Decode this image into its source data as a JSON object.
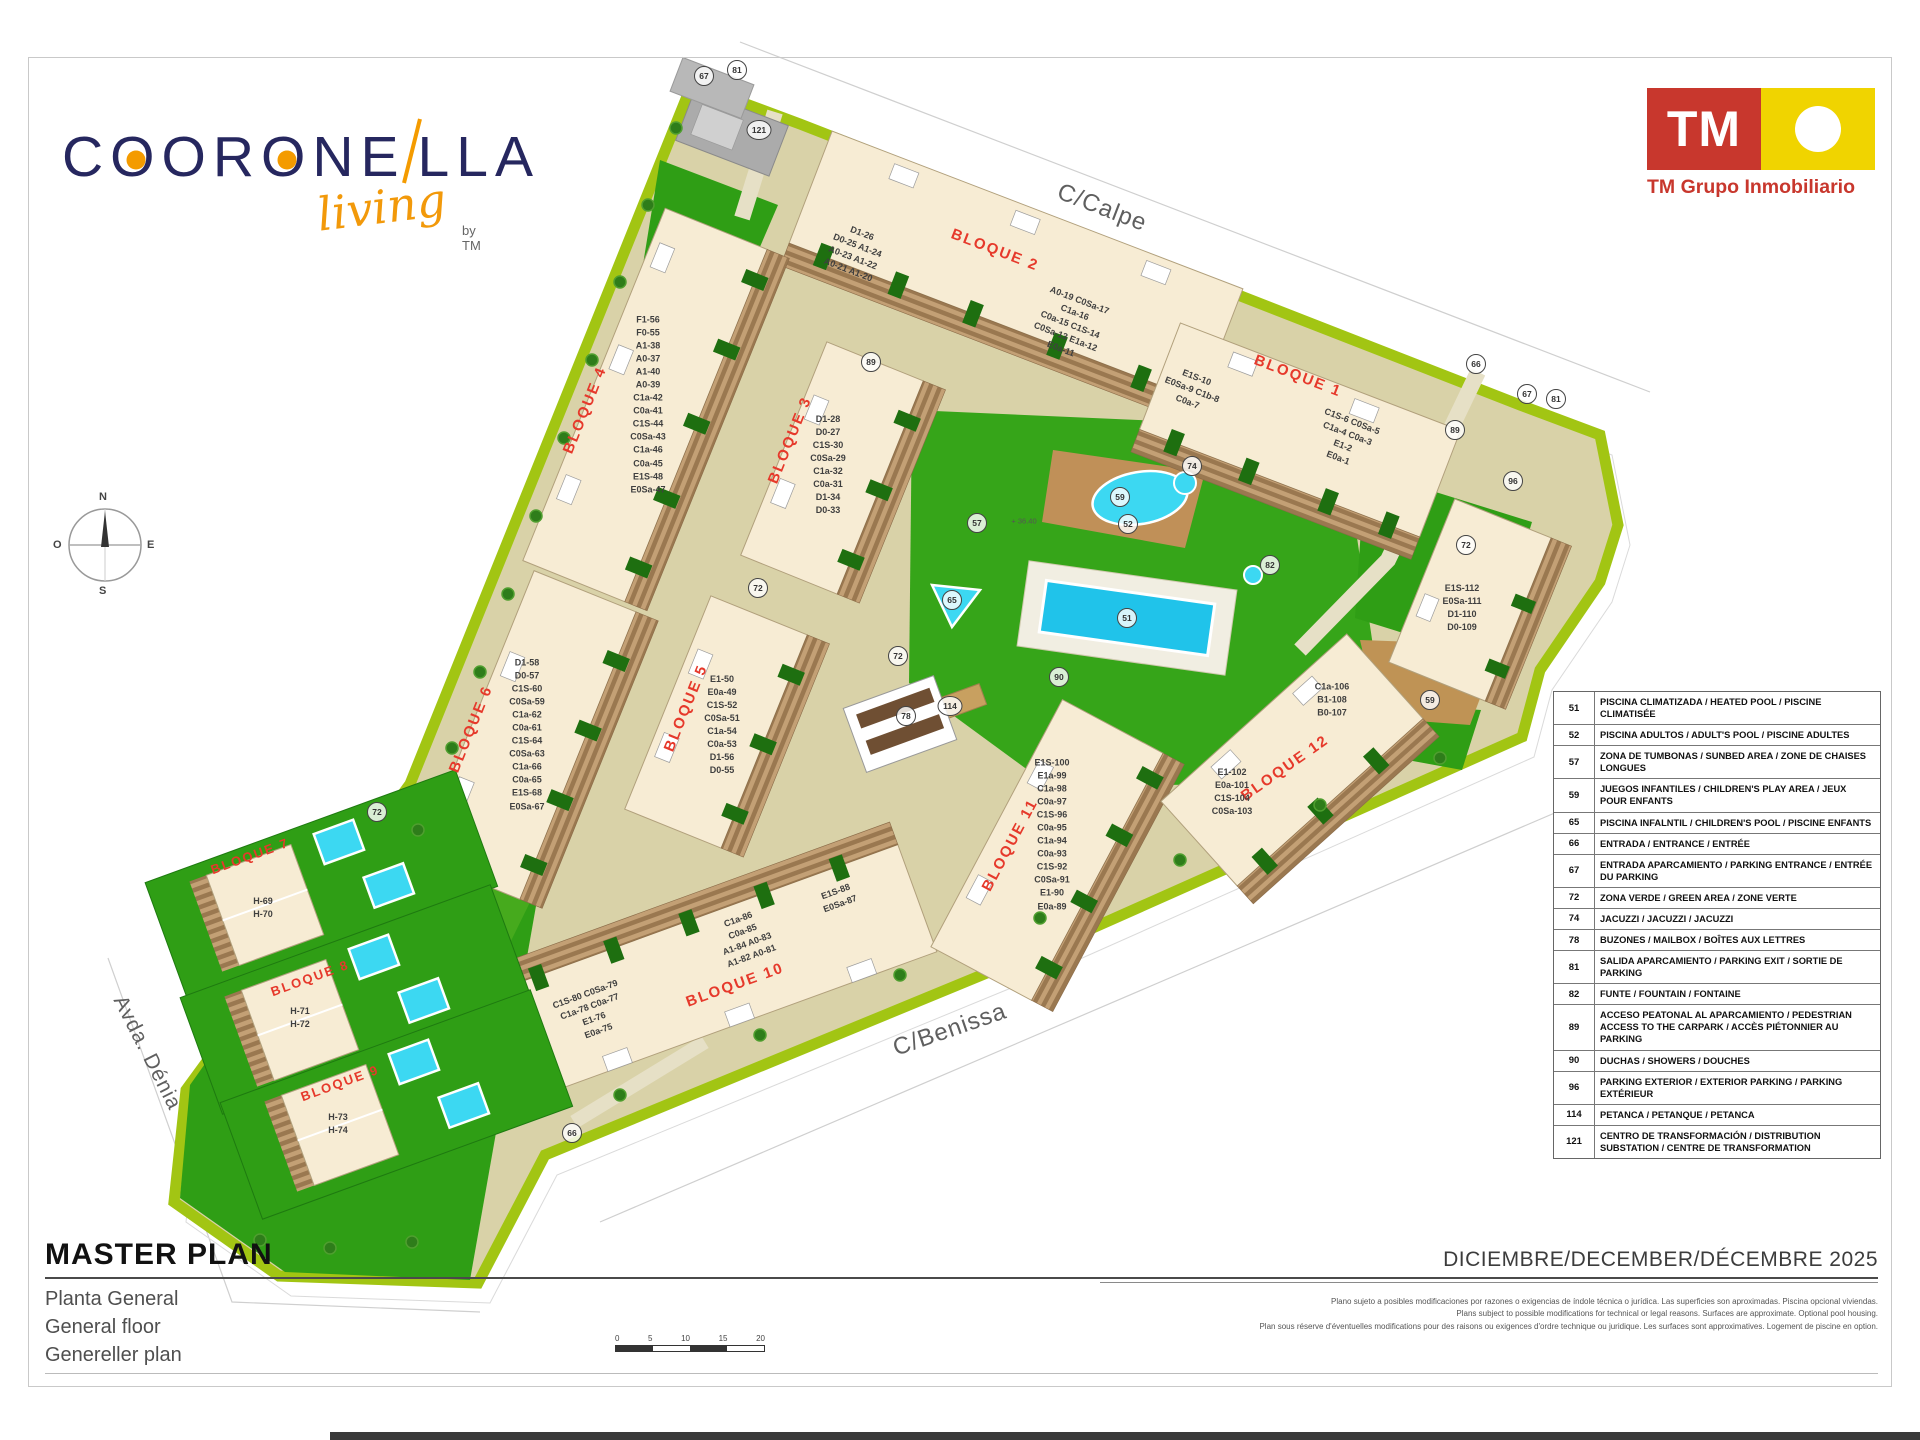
{
  "brand": {
    "wordmark_a": "C",
    "wordmark_b": "OR",
    "wordmark_o": "O",
    "wordmark_c": "NE",
    "wordmark_d": "LLA",
    "script": "living",
    "by": "by TM"
  },
  "tm_logo": {
    "initials": "TM",
    "company": "TM Grupo Inmobiliario"
  },
  "compass": {
    "n": "N",
    "e": "E",
    "s": "S",
    "o": "O"
  },
  "streets": {
    "calpe": "C/Calpe",
    "benissa": "C/Benissa",
    "denia": "Avda. Dénia"
  },
  "map": {
    "levels": {
      "l1": "+ 36.40"
    },
    "bloques": {
      "b1": {
        "label": "BLOQUE 1",
        "units1": "E1S-10\nE0Sa-9 C1b-8\nC0a-7",
        "units2": "C1S-6 C0Sa-5\nC1a-4 C0a-3\nE1-2\nE0a-1"
      },
      "b2": {
        "label": "BLOQUE 2",
        "units1": "D1-26\nD0-25 A1-24\nA0-23 A1-22\nA0-21 A1-20",
        "units2": "A0-19 C0Sa-17\nC1a-16\nC0a-15 C1S-14\nC0Sa-13 E1a-12\nE0a-11"
      },
      "b3": {
        "label": "BLOQUE 3",
        "units": "D1-28\nD0-27\nC1S-30\nC0Sa-29\nC1a-32\nC0a-31\nD1-34\nD0-33"
      },
      "b4": {
        "label": "BLOQUE 4",
        "units": "F1-56\nF0-55\nA1-38\nA0-37\nA1-40\nA0-39\nC1a-42\nC0a-41\nC1S-44\nC0Sa-43\nC1a-46\nC0a-45\nE1S-48\nE0Sa-47"
      },
      "b5": {
        "label": "BLOQUE 5",
        "units": "E1-50\nE0a-49\nC1S-52\nC0Sa-51\nC1a-54\nC0a-53\nD1-56\nD0-55"
      },
      "b6": {
        "label": "BLOQUE 6",
        "units": "D1-58\nD0-57\nC1S-60\nC0Sa-59\nC1a-62\nC0a-61\nC1S-64\nC0Sa-63\nC1a-66\nC0a-65\nE1S-68\nE0Sa-67"
      },
      "b7": {
        "label": "BLOQUE 7",
        "units": "H-69\nH-70"
      },
      "b8": {
        "label": "BLOQUE 8",
        "units": "H-71\nH-72"
      },
      "b9": {
        "label": "BLOQUE 9",
        "units": "H-73\nH-74"
      },
      "b10": {
        "label": "BLOQUE 10",
        "units1": "E1S-88\nE0Sa-87",
        "units2": "C1a-86\nC0a-85\nA1-84 A0-83\nA1-82 A0-81",
        "units3": "C1S-80 C0Sa-79\nC1a-78 C0a-77\nE1-76\nE0a-75"
      },
      "b11": {
        "label": "BLOQUE 11",
        "units": "E1S-100\nE1a-99\nC1a-98\nC0a-97\nC1S-96\nC0a-95\nC1a-94\nC0a-93\nC1S-92\nC0Sa-91\nE1-90\nE0a-89"
      },
      "b12": {
        "label": "BLOQUE 12",
        "units1": "C1a-106\nB1-108\nB0-107",
        "units2": "E1-102\nE0a-101\nC1S-104\nC0Sa-103",
        "units3": "E1S-112\nE0Sa-111\nD1-110\nD0-109"
      }
    },
    "refs": {
      "r121": "121",
      "r67a": "67",
      "r81a": "81",
      "r66a": "66",
      "r67b": "67",
      "r81b": "81",
      "r89a": "89",
      "r89b": "89",
      "r96": "96",
      "r72a": "72",
      "r72b": "72",
      "r72c": "72",
      "r72d": "72",
      "r57": "57",
      "r52": "52",
      "r51": "51",
      "r65": "65",
      "r82": "82",
      "r90": "90",
      "r74": "74",
      "r59a": "59",
      "r59b": "59",
      "r114": "114",
      "r78": "78",
      "r66b": "66"
    }
  },
  "legend": {
    "rows": [
      {
        "num": "51",
        "desc": "PISCINA CLIMATIZADA / HEATED POOL / PISCINE CLIMATISÉE"
      },
      {
        "num": "52",
        "desc": "PISCINA ADULTOS / ADULT'S POOL / PISCINE ADULTES"
      },
      {
        "num": "57",
        "desc": "ZONA DE TUMBONAS / SUNBED AREA / ZONE DE CHAISES LONGUES"
      },
      {
        "num": "59",
        "desc": "JUEGOS INFANTILES / CHILDREN'S PLAY AREA / JEUX POUR ENFANTS"
      },
      {
        "num": "65",
        "desc": "PISCINA INFALNTIL / CHILDREN'S POOL / PISCINE ENFANTS"
      },
      {
        "num": "66",
        "desc": "ENTRADA / ENTRANCE / ENTRÉE"
      },
      {
        "num": "67",
        "desc": "ENTRADA APARCAMIENTO / PARKING ENTRANCE / ENTRÉE DU PARKING"
      },
      {
        "num": "72",
        "desc": "ZONA VERDE / GREEN AREA / ZONE VERTE"
      },
      {
        "num": "74",
        "desc": "JACUZZI / JACUZZI / JACUZZI"
      },
      {
        "num": "78",
        "desc": "BUZONES / MAILBOX / BOÎTES AUX LETTRES"
      },
      {
        "num": "81",
        "desc": "SALIDA APARCAMIENTO / PARKING EXIT / SORTIE DE PARKING"
      },
      {
        "num": "82",
        "desc": "FUNTE / FOUNTAIN / FONTAINE"
      },
      {
        "num": "89",
        "desc": "ACCESO PEATONAL AL APARCAMIENTO / PEDESTRIAN ACCESS TO THE CARPARK / ACCÈS PIÉTONNIER AU PARKING"
      },
      {
        "num": "90",
        "desc": "DUCHAS / SHOWERS / DOUCHES"
      },
      {
        "num": "96",
        "desc": "PARKING EXTERIOR / EXTERIOR PARKING / PARKING EXTÉRIEUR"
      },
      {
        "num": "114",
        "desc": "PETANCA / PETANQUE / PETANCA"
      },
      {
        "num": "121",
        "desc": "CENTRO DE TRANSFORMACIÓN / DISTRIBUTION SUBSTATION / CENTRE DE TRANSFORMATION"
      }
    ]
  },
  "titleblock": {
    "title": "MASTER PLAN",
    "subtitle_es": "Planta General",
    "subtitle_en": "General floor",
    "subtitle_de": "Genereller plan",
    "date": "DICIEMBRE/DECEMBER/DÉCEMBRE 2025",
    "disclaimer_es": "Plano sujeto a posibles modificaciones por razones o exigencias de índole técnica o jurídica. Las superficies son aproximadas. Piscina opcional viviendas.",
    "disclaimer_en": "Plans subject to possible modifications for technical or legal reasons. Surfaces are approximate. Optional pool housing.",
    "disclaimer_fr": "Plan sous réserve d'éventuelles modifications pour des raisons ou exigences d'ordre technique ou juridique. Les surfaces sont approximatives. Logement de piscine en option."
  },
  "scalebar": {
    "t0": "0",
    "t5": "5",
    "t10": "10",
    "t15": "15",
    "t20": "20"
  },
  "colors": {
    "brand_navy": "#26275f",
    "brand_orange": "#f49b00",
    "tm_red": "#c8372d",
    "tm_yellow": "#f0d400",
    "bloque_red": "#e6392b",
    "road_khaki": "#d9d2a8",
    "lawn_green": "#2f9e15",
    "verge_green": "#a2c513",
    "building_beige": "#f7ecd4",
    "parking_brown": "#9a7850",
    "pool_cyan": "#3cd8f2",
    "pool_blue": "#20c3ea",
    "playground_tan": "#c09058"
  }
}
